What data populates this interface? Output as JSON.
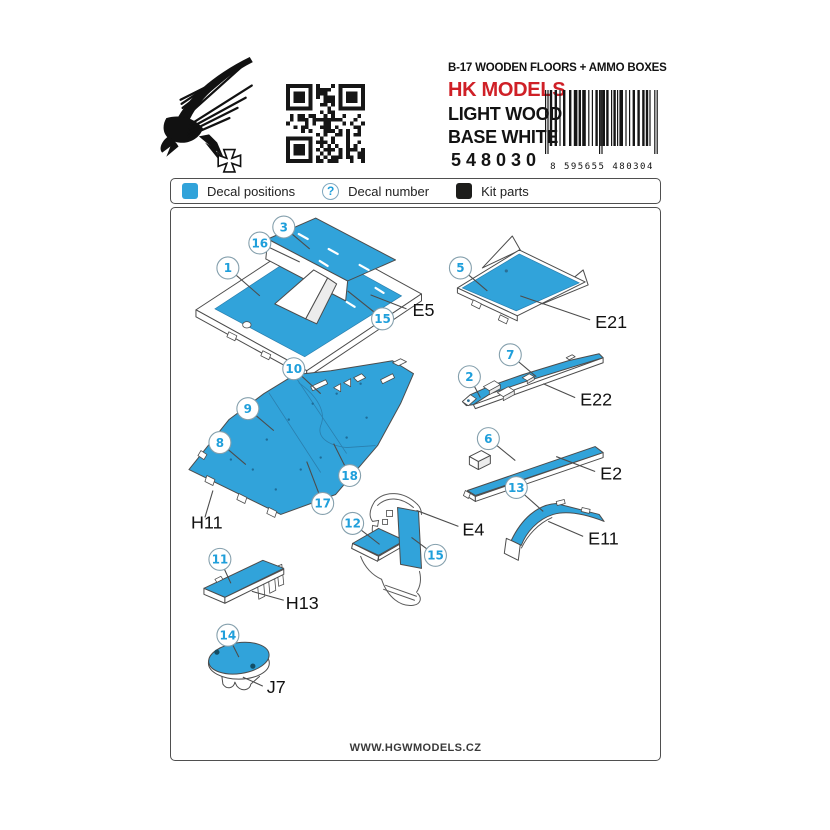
{
  "header": {
    "title": "B-17 WOODEN FLOORS + AMMO BOXES",
    "brand": "HK MODELS",
    "finish_line1": "LIGHT WOOD",
    "finish_line2": "BASE WHITE",
    "product_code": "548030",
    "barcode_digits": "8 595655 480304"
  },
  "legend": {
    "items": [
      {
        "label": "Decal positions"
      },
      {
        "label": "Decal number",
        "symbol": "?"
      },
      {
        "label": "Kit parts"
      }
    ]
  },
  "diagram": {
    "callouts": [
      {
        "num": "3"
      },
      {
        "num": "16"
      },
      {
        "num": "1"
      },
      {
        "num": "15"
      },
      {
        "num": "5"
      },
      {
        "num": "10"
      },
      {
        "num": "9"
      },
      {
        "num": "8"
      },
      {
        "num": "18"
      },
      {
        "num": "17"
      },
      {
        "num": "7"
      },
      {
        "num": "2"
      },
      {
        "num": "6"
      },
      {
        "num": "13"
      },
      {
        "num": "12"
      },
      {
        "num": "15"
      },
      {
        "num": "11"
      },
      {
        "num": "14"
      }
    ],
    "part_labels": [
      {
        "text": "E5"
      },
      {
        "text": "E21"
      },
      {
        "text": "E22"
      },
      {
        "text": "E2"
      },
      {
        "text": "E11"
      },
      {
        "text": "H11"
      },
      {
        "text": "E4"
      },
      {
        "text": "H13"
      },
      {
        "text": "J7"
      }
    ]
  },
  "footer": {
    "website": "WWW.HGWMODELS.CZ"
  },
  "colors": {
    "decal_blue": "#31a3da",
    "callout_blue": "#1f9fdb",
    "brand_red": "#cf2027",
    "kit_black": "#1d1d1b"
  }
}
